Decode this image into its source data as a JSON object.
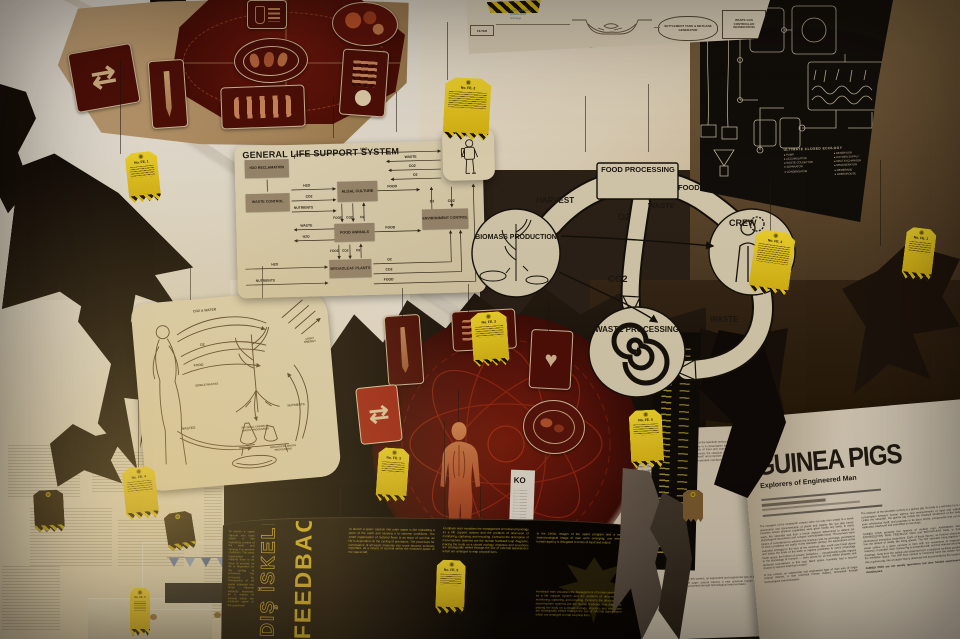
{
  "colors": {
    "tag_yellow": "#f0cf1c",
    "panel_cream": "#ded2b4",
    "deep_red": "#5a100a",
    "text_yellow": "#d9b832",
    "black_panel": "#0f0c09"
  },
  "glyphs": {
    "recycle": "⇄",
    "heart": "♥"
  },
  "glss": {
    "title": "GENERAL LIFE SUPPORT SYSTEM",
    "crew": "CREW",
    "boxes": {
      "h2o_reclamation": "H2O RECLAMATION",
      "waste_control": "WASTE CONTROL",
      "algal_culture": "ALGAL CULTURE",
      "food_animals": "FOOD ANIMALS",
      "broadleaf_plants": "BROADLEAF PLANTS",
      "environment_control": "ENVIRONMENT CONTROL"
    },
    "flow": [
      "H2O",
      "WASTE",
      "CO2",
      "O2",
      "H2O",
      "CO2",
      "NUTRIENTS",
      "FOOD",
      "FOOD",
      "CO2",
      "O2",
      "WASTE",
      "H2O",
      "FOOD",
      "FOOD",
      "CO2",
      "O2",
      "O2",
      "CO2",
      "H2O",
      "NUTRIENTS",
      "O2",
      "CO2",
      "FOOD"
    ]
  },
  "cycle": {
    "food_processing": "FOOD PROCESSING",
    "harvest": "HARVEST",
    "food": "FOOD",
    "waste_top": "WASTE",
    "o2": "O2",
    "co2": "CO2",
    "crew": "CREW",
    "waste_right": "WASTE",
    "biomass": "BIOMASS PRODUCTION",
    "waste_processing": "WASTE PROCESSING"
  },
  "aqua": {
    "filter": "FILTER",
    "veg": "fresh vegetables",
    "h2o": "potable H2O",
    "drain": "drainage",
    "fish": "fish wastes",
    "settlement": "SETTLEMENT TANK & METHANE GENERATOR",
    "incineration": "WASTE GAS CONTROLLED INCINERATION"
  },
  "eco": {
    "title": "ULTIMATE CLOSED ECOLOGY",
    "left": [
      "PUMP",
      "ACCUMULATOR",
      "WASTE COLLECTOR",
      "SEPARATOR",
      "CONDENSATOR"
    ],
    "right": [
      "RESERVOIR",
      "OXYGEN SUPPLY",
      "HEAT EXCHANGER",
      "REGENERATOR",
      "MEMBRANE",
      "GREENHOUSE"
    ]
  },
  "human_plant": {
    "labels": [
      "CO2 & WATER",
      "O2",
      "FOOD",
      "EDIBLE WASTES",
      "WASTES",
      "NUTRIENTS",
      "LIGHT ENERGY",
      "PHYSICAL CHEMICAL WASTE PROCESSING",
      "BIOLOGICAL WASTE PROCESSING"
    ]
  },
  "feedback": {
    "title_en": "FEEDBACK MAN",
    "title_tr": "DIŞ İSKELET",
    "p1": "To launch a space capsule into outer space is like replicating a piece of the earth and carrying it to extreme conditions. The smart organisation of material flows is an issue of survival, as life is dependent on the cycling of provisions. The processes for conveyance of all waste materials into reuse become seriously important, as a means of survival within the enclosed space of the spacecraft.",
    "p2": "Feedback man visualises the management of human physiology as a life support system and the problem of obsession of monitoring, capturing, and recycling. Central to the description of man-machine systems are the human feedback loop diagrams, placing the body on a closed ecology. Impulses and secretions are strategically edited through the use of external apparatuses which are arranged to map corporal lives.",
    "p3": "In the 1960s, images of the space program and a new biotechnological image of man were emerging, one where human agency is delegated in terms of input and output."
  },
  "ko": {
    "title": "KO"
  },
  "guinea": {
    "title": "GUINEA PIGS",
    "subtitle": "Explorers of Engineered Man",
    "col1_p1": "The voyagers of the nineteenth century were not only men united to a serial observation and documentation of plants and organic life, but also heroic travelers whose physical capabilities were given hardly any limits. In many ways, the naturalist was then a heroic explorer determined to defend his physiological boundaries and conquer uninhabitable lands. His journeys were tokens of commitment to advance the sciences and, by and large, perceptions of what constitutes our world. In the twentieth century, the explorations of the naturalist emerged in the face of the universal, who could now travel above and below the limits of the earth in regions prohibitive to man's physiology. Outer space, the bottom of oceans, Antarctica — exceptionally hostile regions to the physiology of humans — were prizes for all that defied property and territorial commitment. In this vast, blank space, humanity had a second chance to reinvent itself from scratch.",
    "col1_p2": "In this context, an augmented and engineered type of man was of larger cultural interest, a new universal human subject, reinvented through technological instrumentation.",
    "col2_p1": "The explorer of the twentieth century is a guinea pig: his body is a test bed; he is a conversation between human agency and measurements of input and output. Unlike the naturalist, the guinea pig resists the classical wholeness of the body, even 'wholeness' itself, and proposes in its place kinetic components that can be replicated, interfaced and intensified in new ways.",
    "col2_p2": "GUINEA PIGS presents five species of modern man: AMPHIBIAN MAN, EXOSKELETON MAN, FEEDBACK MAN and WEIGHTLESS MAN, in three-dimensional immersive projections. Each of these figures, as fictional characters, has the texture of reality, like living ghosts. The five episodes bring together the visual culture of a given moment in time with the investment of engineering research. In parallel, each Guinea Pig is presented with archival material and patent drawings, hung from the ceiling and observed from a designed reclining position in the exhibition space. The shift from vertical to horizontal turns the viewer himself into a guinea pig, into an object that is observed and documented by the curators.",
    "col2_p3": "GUINEA PIGS are not merely specimens but also funded experiments to manufacture."
  },
  "tags": {
    "ids": [
      "No. FE. 1",
      "No. FE. 2",
      "No. FE. 3",
      "No. FE. 4",
      "No. FE. 5"
    ]
  }
}
